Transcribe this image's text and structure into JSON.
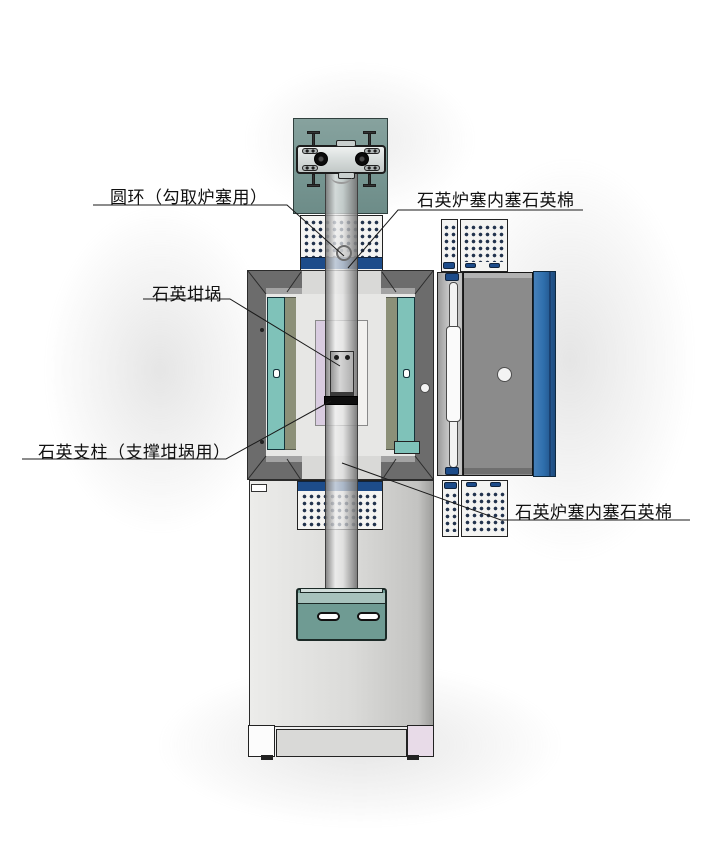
{
  "labels": {
    "ring": "圆环（勾取炉塞用）",
    "wool_top": "石英炉塞内塞石英棉",
    "crucible": "石英坩埚",
    "support": "石英支柱（支撑坩埚用）",
    "wool_bottom": "石英炉塞内塞石英棉"
  },
  "colors": {
    "plate_teal": "#7b9a96",
    "clamp_gray": "#d9dedd",
    "heater_teal": "#7fc2b9",
    "insulation_olive": "#8c9078",
    "frame_gray": "#6c6c6c",
    "frame_line": "#2b2b2b",
    "cavity_gray": "#e7e7e5",
    "plug_white": "#f4f4f2",
    "wool_dot": "#22334d",
    "seal_blue": "#1d4c8a",
    "side_blue": "#2f6fad",
    "base_gray": "#dbdbd9",
    "bracket_teal": "#6f9b93",
    "lavender": "#d9cce0",
    "footer_pink": "#e8dbe8",
    "tube_edge": "#3f3f3f",
    "ink": "#1a1a1a"
  }
}
